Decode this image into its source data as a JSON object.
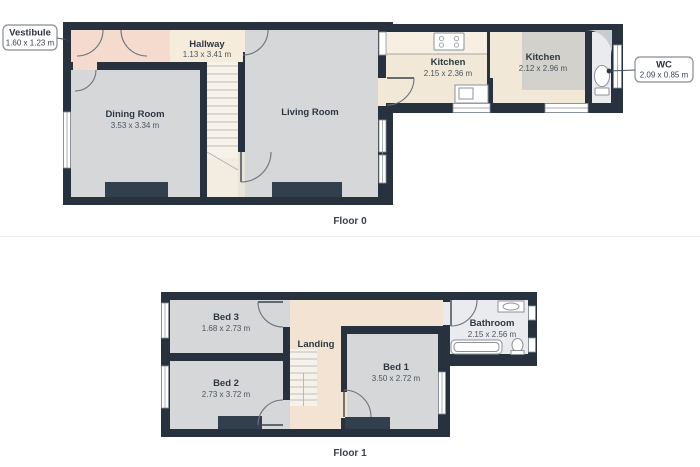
{
  "page": {
    "background": "#ffffff"
  },
  "colors": {
    "wall": "#27323e",
    "chimney": "#323f4c",
    "room_gray": "#d6d7d9",
    "cream": "#f2e8d7",
    "cream_light": "#f7f0e2",
    "pink": "#f4dbcd",
    "hall_cream": "#f6ecdc",
    "corridor": "#f3ece1",
    "stairs_bg": "#f7f2e8",
    "landing_cream": "#f2e3d3",
    "room_white": "#e9ebee",
    "kitchen_gray": "#d2d1cb",
    "curve_gray": "#c7ccd1",
    "opening": "#e8e4da"
  },
  "floors": [
    {
      "name": "Floor 0",
      "callouts": [
        {
          "title": "Vestibule",
          "dims": "1.60 x 1.23 m"
        },
        {
          "title": "WC",
          "dims": "2.09 x 0.85 m"
        }
      ],
      "rooms": [
        {
          "name": "Hallway",
          "dims": "1.13 x 3.41 m"
        },
        {
          "name": "Dining Room",
          "dims": "3.53 x 3.34 m"
        },
        {
          "name": "Living Room",
          "dims": ""
        },
        {
          "name": "Kitchen",
          "dims": "2.15 x 2.36 m"
        },
        {
          "name": "Kitchen",
          "dims": "2.12 x 2.96 m"
        }
      ]
    },
    {
      "name": "Floor 1",
      "callouts": [],
      "rooms": [
        {
          "name": "Bed 3",
          "dims": "1.68 x 2.73 m"
        },
        {
          "name": "Bed 2",
          "dims": "2.73 x 3.72 m"
        },
        {
          "name": "Landing",
          "dims": ""
        },
        {
          "name": "Bed 1",
          "dims": "3.50 x 2.72 m"
        },
        {
          "name": "Bathroom",
          "dims": "2.15 x 2.56 m"
        }
      ]
    }
  ]
}
